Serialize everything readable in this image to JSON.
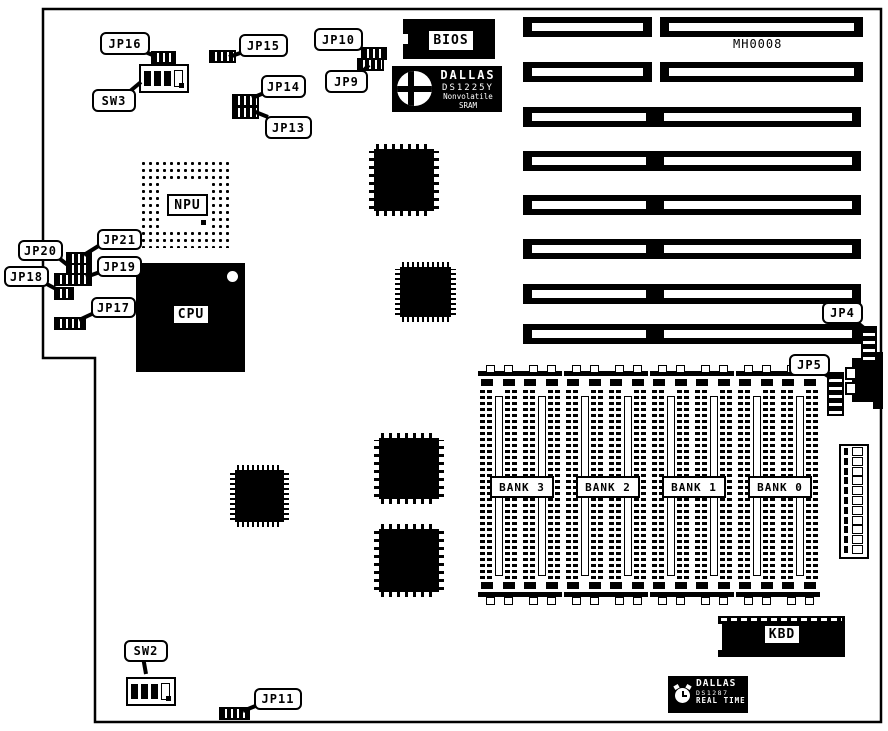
{
  "diagram": {
    "part_number": "MH0008",
    "callouts": {
      "jp16": "JP16",
      "sw3": "SW3",
      "jp15": "JP15",
      "jp14": "JP14",
      "jp13": "JP13",
      "jp10": "JP10",
      "jp9": "JP9",
      "jp21": "JP21",
      "jp20": "JP20",
      "jp19": "JP19",
      "jp18": "JP18",
      "jp17": "JP17",
      "jp4": "JP4",
      "jp5": "JP5",
      "sw2": "SW2",
      "jp11": "JP11"
    },
    "chips": {
      "bios": "BIOS",
      "npu": "NPU",
      "cpu": "CPU",
      "kbd": "KBD",
      "dallas_sram": {
        "brand": "DALLAS",
        "part": "DS1225Y",
        "line3": "Nonvolatile SRAM"
      },
      "dallas_rtc": {
        "brand": "DALLAS",
        "part": "DS1287",
        "line3": "REAL TIME"
      }
    },
    "memory_banks": [
      "BANK 3",
      "BANK 2",
      "BANK 1",
      "BANK 0"
    ]
  }
}
